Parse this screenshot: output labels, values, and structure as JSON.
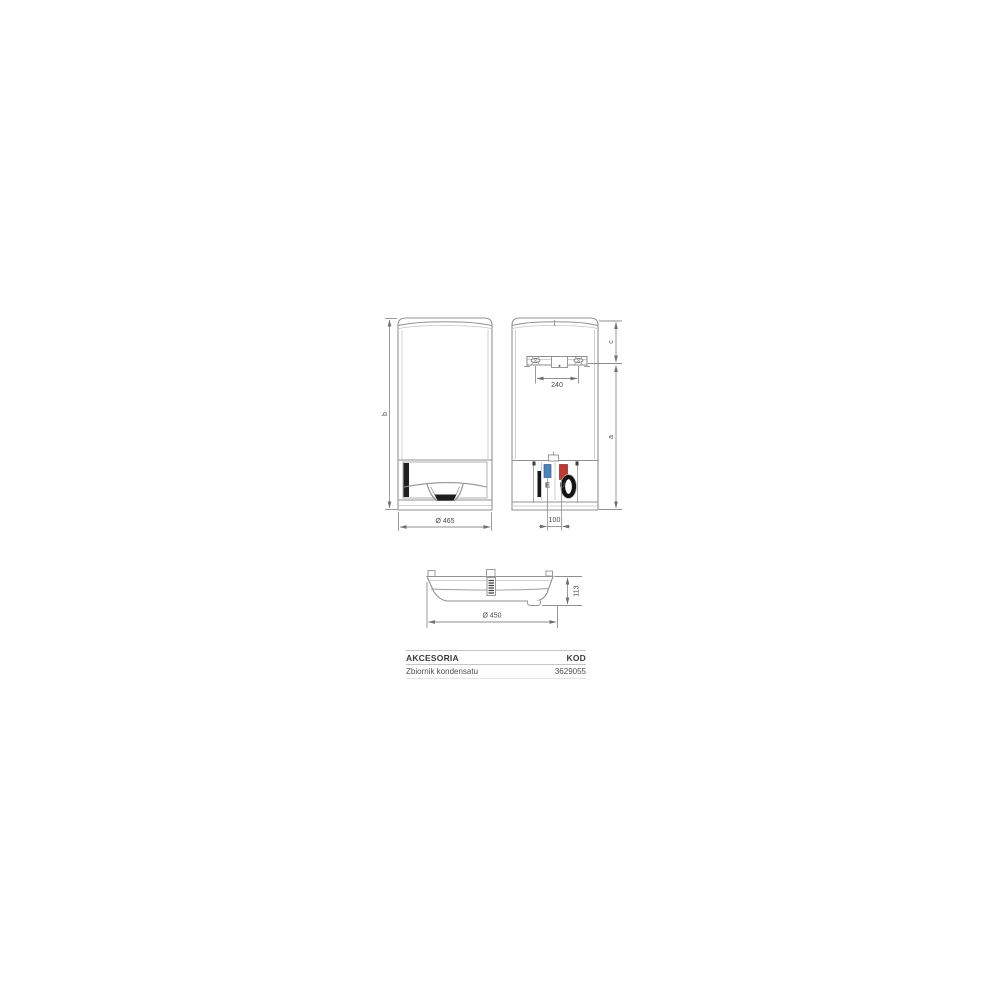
{
  "drawing": {
    "front_view": {
      "dim_height": "b",
      "dim_width": "Ø 465"
    },
    "back_view": {
      "dim_bracket_offset": "c",
      "dim_body_height": "a",
      "dim_bracket_holes": "240",
      "dim_pipe_spacing": "100",
      "label_inlet": "E",
      "label_outlet": "U"
    },
    "top_view": {
      "dim_width": "Ø 450",
      "dim_depth": "113"
    },
    "colors": {
      "inlet_fill": "#4b83b8",
      "inlet_text": "#7fb3de",
      "outlet_fill": "#c03a33",
      "outlet_text": "#c03a33"
    }
  },
  "table": {
    "header": {
      "accessories": "AKCESORIA",
      "code": "KOD"
    },
    "row": {
      "accessory": "Zbiornik kondensatu",
      "code": "3629055"
    }
  }
}
